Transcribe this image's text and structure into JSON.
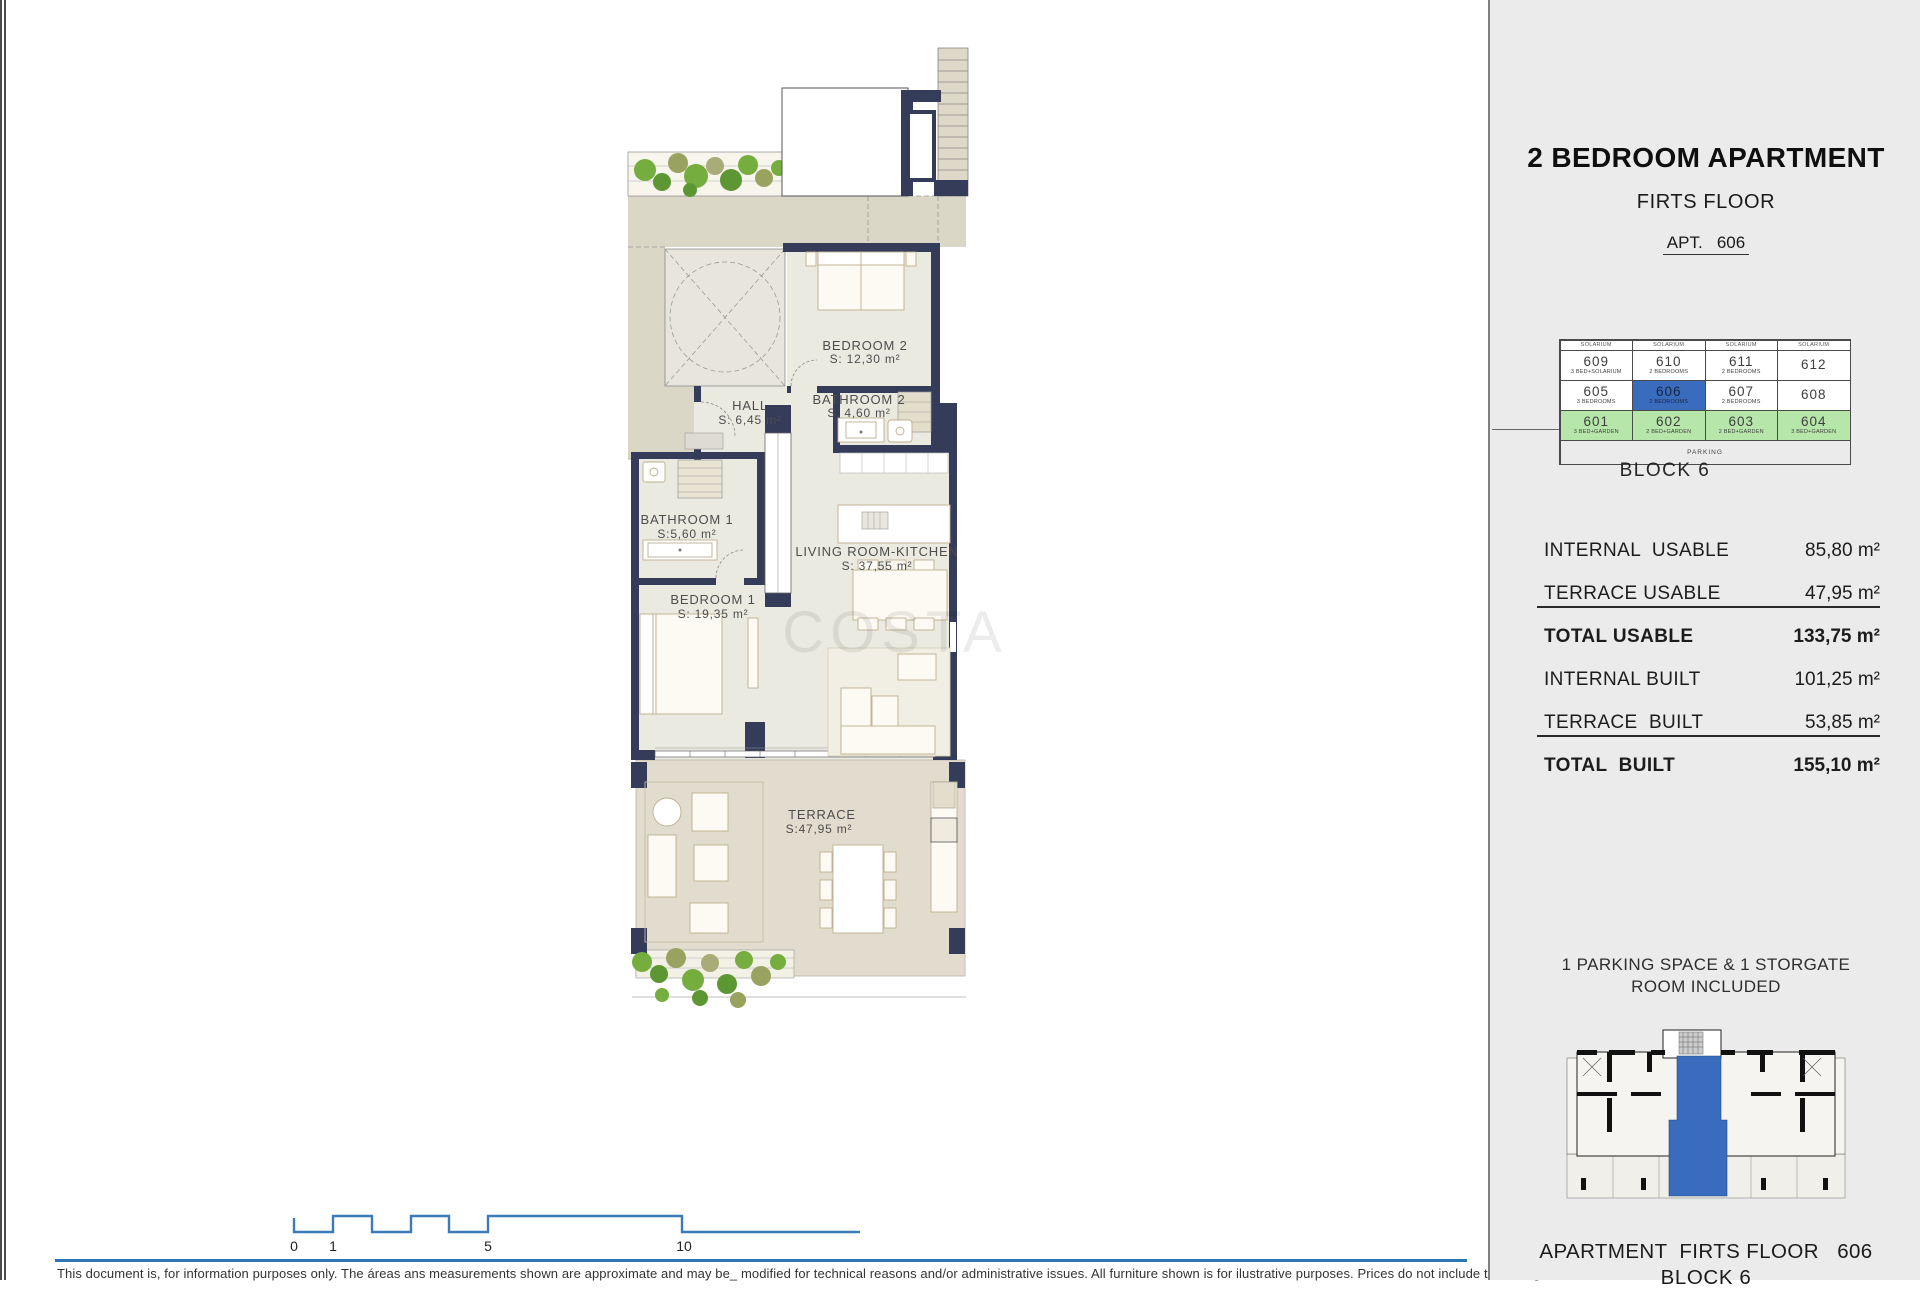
{
  "page": {
    "watermark": "COSTA",
    "disclaimer": "This document is, for information purposes only. The áreas ans measurements shown are approximate and may be_ modified for technical reasons and/or administrative issues. All furniture shown is for ilustrative purposes. Prices do not include taxes, legal"
  },
  "plan": {
    "rooms": [
      {
        "name": "BEDROOM 2",
        "area": "S: 12,30 m²"
      },
      {
        "name": "BATHROOM 2",
        "area": "S: 4,60 m²"
      },
      {
        "name": "HALL",
        "area": "S:  6,45 m²"
      },
      {
        "name": "BATHROOM 1",
        "area": "S:5,60 m²"
      },
      {
        "name": "BEDROOM 1",
        "area": "S: 19,35 m²"
      },
      {
        "name": "LIVING ROOM-KITCHEN",
        "area": "S: 37,55 m²"
      },
      {
        "name": "TERRACE",
        "area": "S:47,95  m²"
      }
    ]
  },
  "scalebar": {
    "labels": [
      "0",
      "1",
      "5",
      "10"
    ]
  },
  "panel": {
    "title": "2 BEDROOM APARTMENT",
    "subtitle": "FIRTS FLOOR",
    "apt_label": "APT.   606",
    "block_grid": {
      "header": [
        "SOLARIUM",
        "SOLARIUM",
        "SOLARIUM",
        "SOLARIUM"
      ],
      "rows": [
        {
          "cells": [
            {
              "num": "609",
              "type": "3 BED+SOLARIUM"
            },
            {
              "num": "610",
              "type": "2 BEDROOMS"
            },
            {
              "num": "611",
              "type": "2 BEDROOMS"
            },
            {
              "num": "612",
              "type": ""
            }
          ]
        },
        {
          "cells": [
            {
              "num": "605",
              "type": "3 BEDROOMS"
            },
            {
              "num": "606",
              "type": "2 BEDROOMS"
            },
            {
              "num": "607",
              "type": "2 BEDROOMS"
            },
            {
              "num": "608",
              "type": ""
            }
          ]
        },
        {
          "cells": [
            {
              "num": "601",
              "type": "3 BED+GARDEN"
            },
            {
              "num": "602",
              "type": "2 BED+GARDEN"
            },
            {
              "num": "603",
              "type": "2 BED+GARDEN"
            },
            {
              "num": "604",
              "type": "3 BED+GARDEN"
            }
          ]
        }
      ],
      "parking": "PARKING",
      "caption": "BLOCK 6"
    },
    "areas": [
      {
        "label": "INTERNAL  USABLE",
        "value": "85,80 m²"
      },
      {
        "label": "TERRACE USABLE",
        "value": "47,95 m²"
      },
      {
        "label": "TOTAL USABLE",
        "value": "133,75 m²"
      },
      {
        "label": "INTERNAL BUILT",
        "value": "101,25 m²"
      },
      {
        "label": "TERRACE  BUILT",
        "value": "53,85 m²"
      },
      {
        "label": "TOTAL  BUILT",
        "value": "155,10 m²"
      }
    ],
    "parking_note_line1": "1 PARKING SPACE & 1 STORGATE",
    "parking_note_line2": "ROOM INCLUDED",
    "footer_line1": "APARTMENT  FIRTS FLOOR   606",
    "footer_line2": "BLOCK 6"
  },
  "colors": {
    "wall_navy": "#343c5a",
    "highlight_blue": "#3a6cbd",
    "garden_green_cell": "#b6e6aa",
    "plant_green": "#76ad3f",
    "terrace_floor": "#e1dccd",
    "room_floor": "#ebeae1",
    "common_beige": "#dbd7c6",
    "panel_gray": "#ebebeb",
    "scalebar_blue": "#3c7ab8",
    "rule_blue": "#2d74b4"
  }
}
